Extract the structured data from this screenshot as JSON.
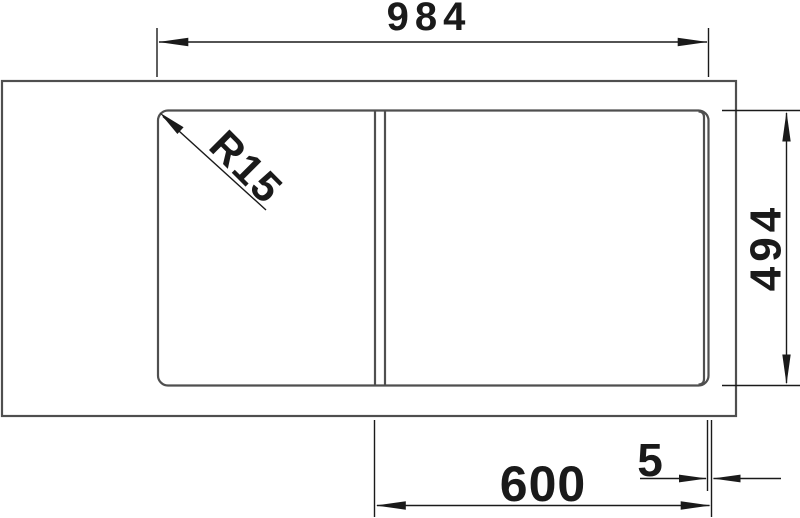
{
  "drawing": {
    "dimension_labels": {
      "overall_width": "984",
      "overall_depth": "494",
      "bowl_width": "600",
      "edge_offset": "5",
      "corner_radius": "R15"
    },
    "colors": {
      "background": "#ffffff",
      "outline": "#4f4f4f",
      "dimension": "#1a1a1a"
    }
  }
}
